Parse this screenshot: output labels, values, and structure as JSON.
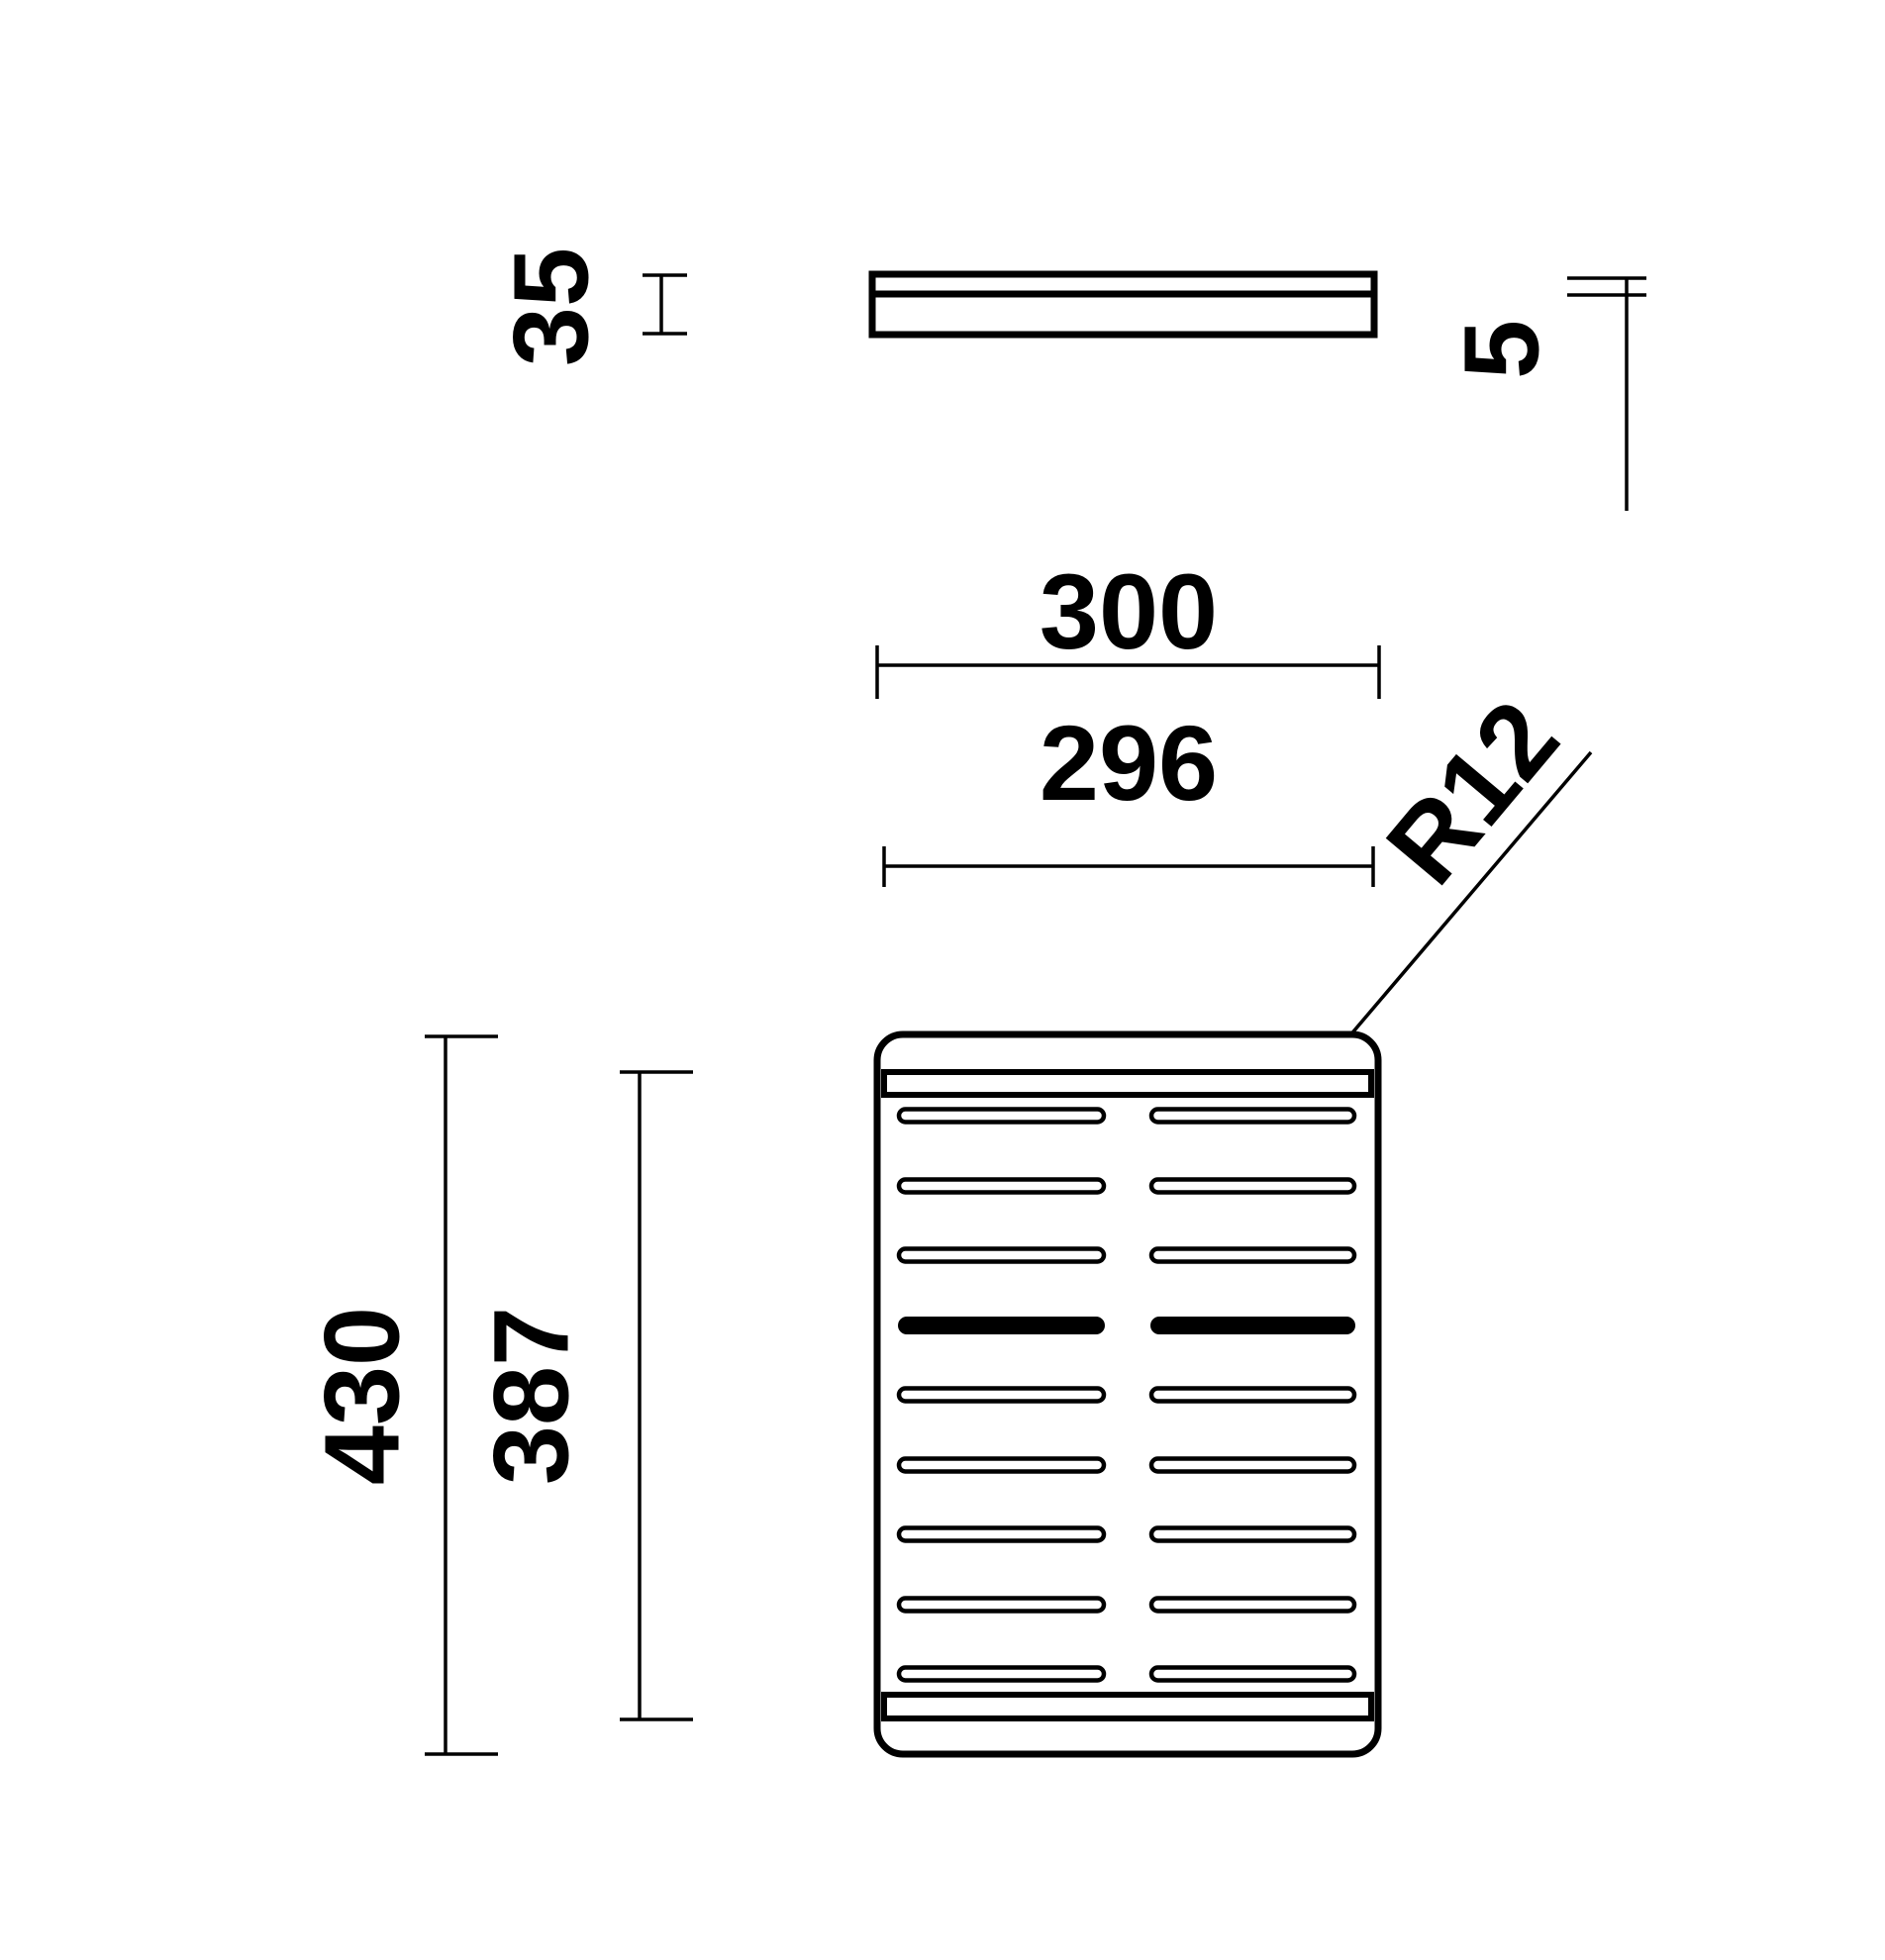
{
  "drawing": {
    "background_color": "#ffffff",
    "line_color": "#000000",
    "dimensions": {
      "side_thickness": "35",
      "plate_thickness": "5",
      "width_outer": "300",
      "width_inner": "296",
      "corner_radius": "R12",
      "length_outer": "430",
      "length_inner": "387"
    }
  }
}
